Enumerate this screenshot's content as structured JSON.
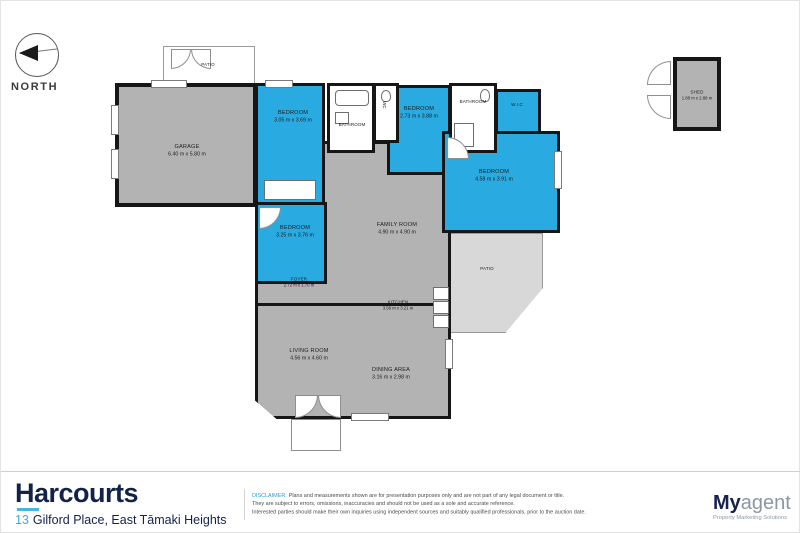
{
  "compass": {
    "label": "NORTH"
  },
  "rooms": {
    "patio_top": {
      "name": "PATIO"
    },
    "garage": {
      "name": "GARAGE",
      "dims": "6.40 m x 5.80 m"
    },
    "bedroom1": {
      "name": "BEDROOM",
      "dims": "3.05 m x 3.69 m"
    },
    "bathroom_left": {
      "name": "BATHROOM"
    },
    "wc": {
      "name": "WC"
    },
    "bedroom2": {
      "name": "BEDROOM",
      "dims": "2.73 m x 3.88 m"
    },
    "bathroom_right": {
      "name": "BATHROOM"
    },
    "wic": {
      "name": "W.I.C"
    },
    "bedroom_master": {
      "name": "BEDROOM",
      "dims": "4.58 m x 3.91 m"
    },
    "family_room": {
      "name": "FAMILY ROOM",
      "dims": "4.90 m x 4.90 m"
    },
    "bedroom4": {
      "name": "BEDROOM",
      "dims": "3.25 m x 3.76 m"
    },
    "foyer": {
      "name": "FOYER",
      "dims": "2.72 m x 1.70 m"
    },
    "kitchen": {
      "name": "KITCHEN",
      "dims": "3.58 m x 3.21 m"
    },
    "living_room": {
      "name": "LIVING ROOM",
      "dims": "4.56 m x 4.60 m"
    },
    "dining_area": {
      "name": "DINING AREA",
      "dims": "3.16 m x 2.98 m"
    },
    "patio_right": {
      "name": "PATIO"
    },
    "shed": {
      "name": "SHED",
      "dims": "1.88 m x 2.88 m"
    }
  },
  "footer": {
    "brand": "Harcourts",
    "address_number": "13",
    "address": "Gilford Place, East Tāmaki Heights",
    "disclaimer_label": "DISCLAIMER:",
    "disclaimer_lines": [
      "Plans and measurements shown are for presentation purposes only and are not part of any legal document or title.",
      "They are subject to errors, omissions, inaccuracies and should not be used as a sole and accurate reference.",
      "Interested parties should make their own inquiries using independent sources and suitably qualified professionals, prior to the auction date."
    ],
    "logo": {
      "part1": "My",
      "part2": "agent",
      "tagline": "Property Marketing Solutions"
    }
  },
  "colors": {
    "room_gray": "#b3b3b3",
    "room_blue": "#29abe2",
    "wall": "#161616",
    "patio_gray": "#d8d8d8",
    "brand_navy": "#132248",
    "accent_blue": "#3fa8dd"
  }
}
